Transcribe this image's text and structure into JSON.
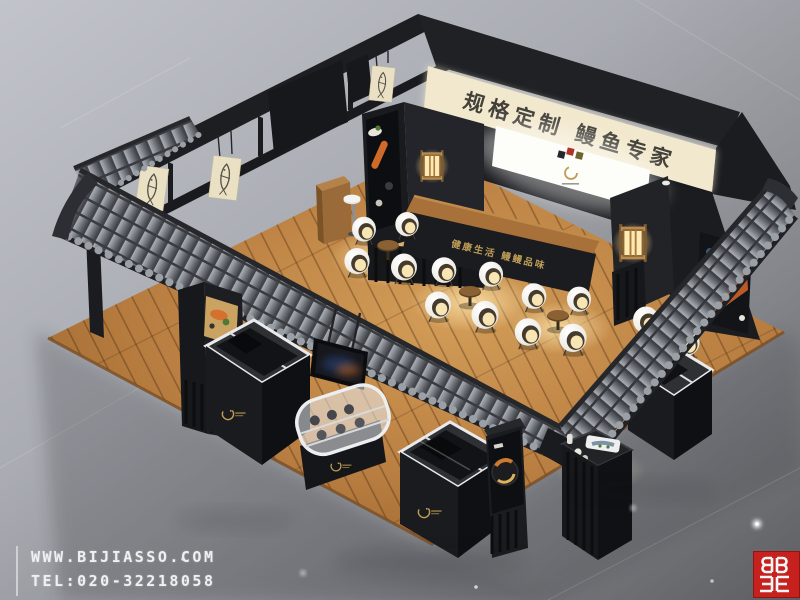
{
  "scene": {
    "type": "3d-exhibition-booth-render",
    "title_banner": "规格定制  鳗鱼专家",
    "counter_slogan": "健康生活  鳗鳗品味"
  },
  "watermark": {
    "website": "WWW.BIJIASSO.COM",
    "tel": "TEL:020-32218058"
  },
  "brand_logo": {
    "name": "bijiasso-red-logo",
    "color": "#c7211e"
  },
  "colors": {
    "background_top": "#c0c3c9",
    "background_bottom": "#606266",
    "booth_black": "#1d1e22",
    "banner_cream": "#f2e8cd",
    "calligraphy": "#34322e",
    "roof_tile_grey": "#7d8187",
    "wood_floor": "#b97e41",
    "gold_accent": "#c49a52",
    "lantern_glow": "#ffe8ad",
    "chair_white": "#f2f0ea",
    "logo_red": "#c7211e"
  },
  "objects": [
    "tiled-chinese-roof",
    "fish-print-banners",
    "calligraphy-banner",
    "led-light-screen",
    "food-poster-pillar",
    "japanese-lanterns",
    "pod-chairs",
    "round-tea-tables",
    "bar-stool",
    "wood-cabinet",
    "reception-counter",
    "chest-freezer-left",
    "chest-freezer-center",
    "chest-freezer-right",
    "curved-display-case",
    "tv-screen",
    "food-display-stand",
    "wood-plank-floor"
  ]
}
